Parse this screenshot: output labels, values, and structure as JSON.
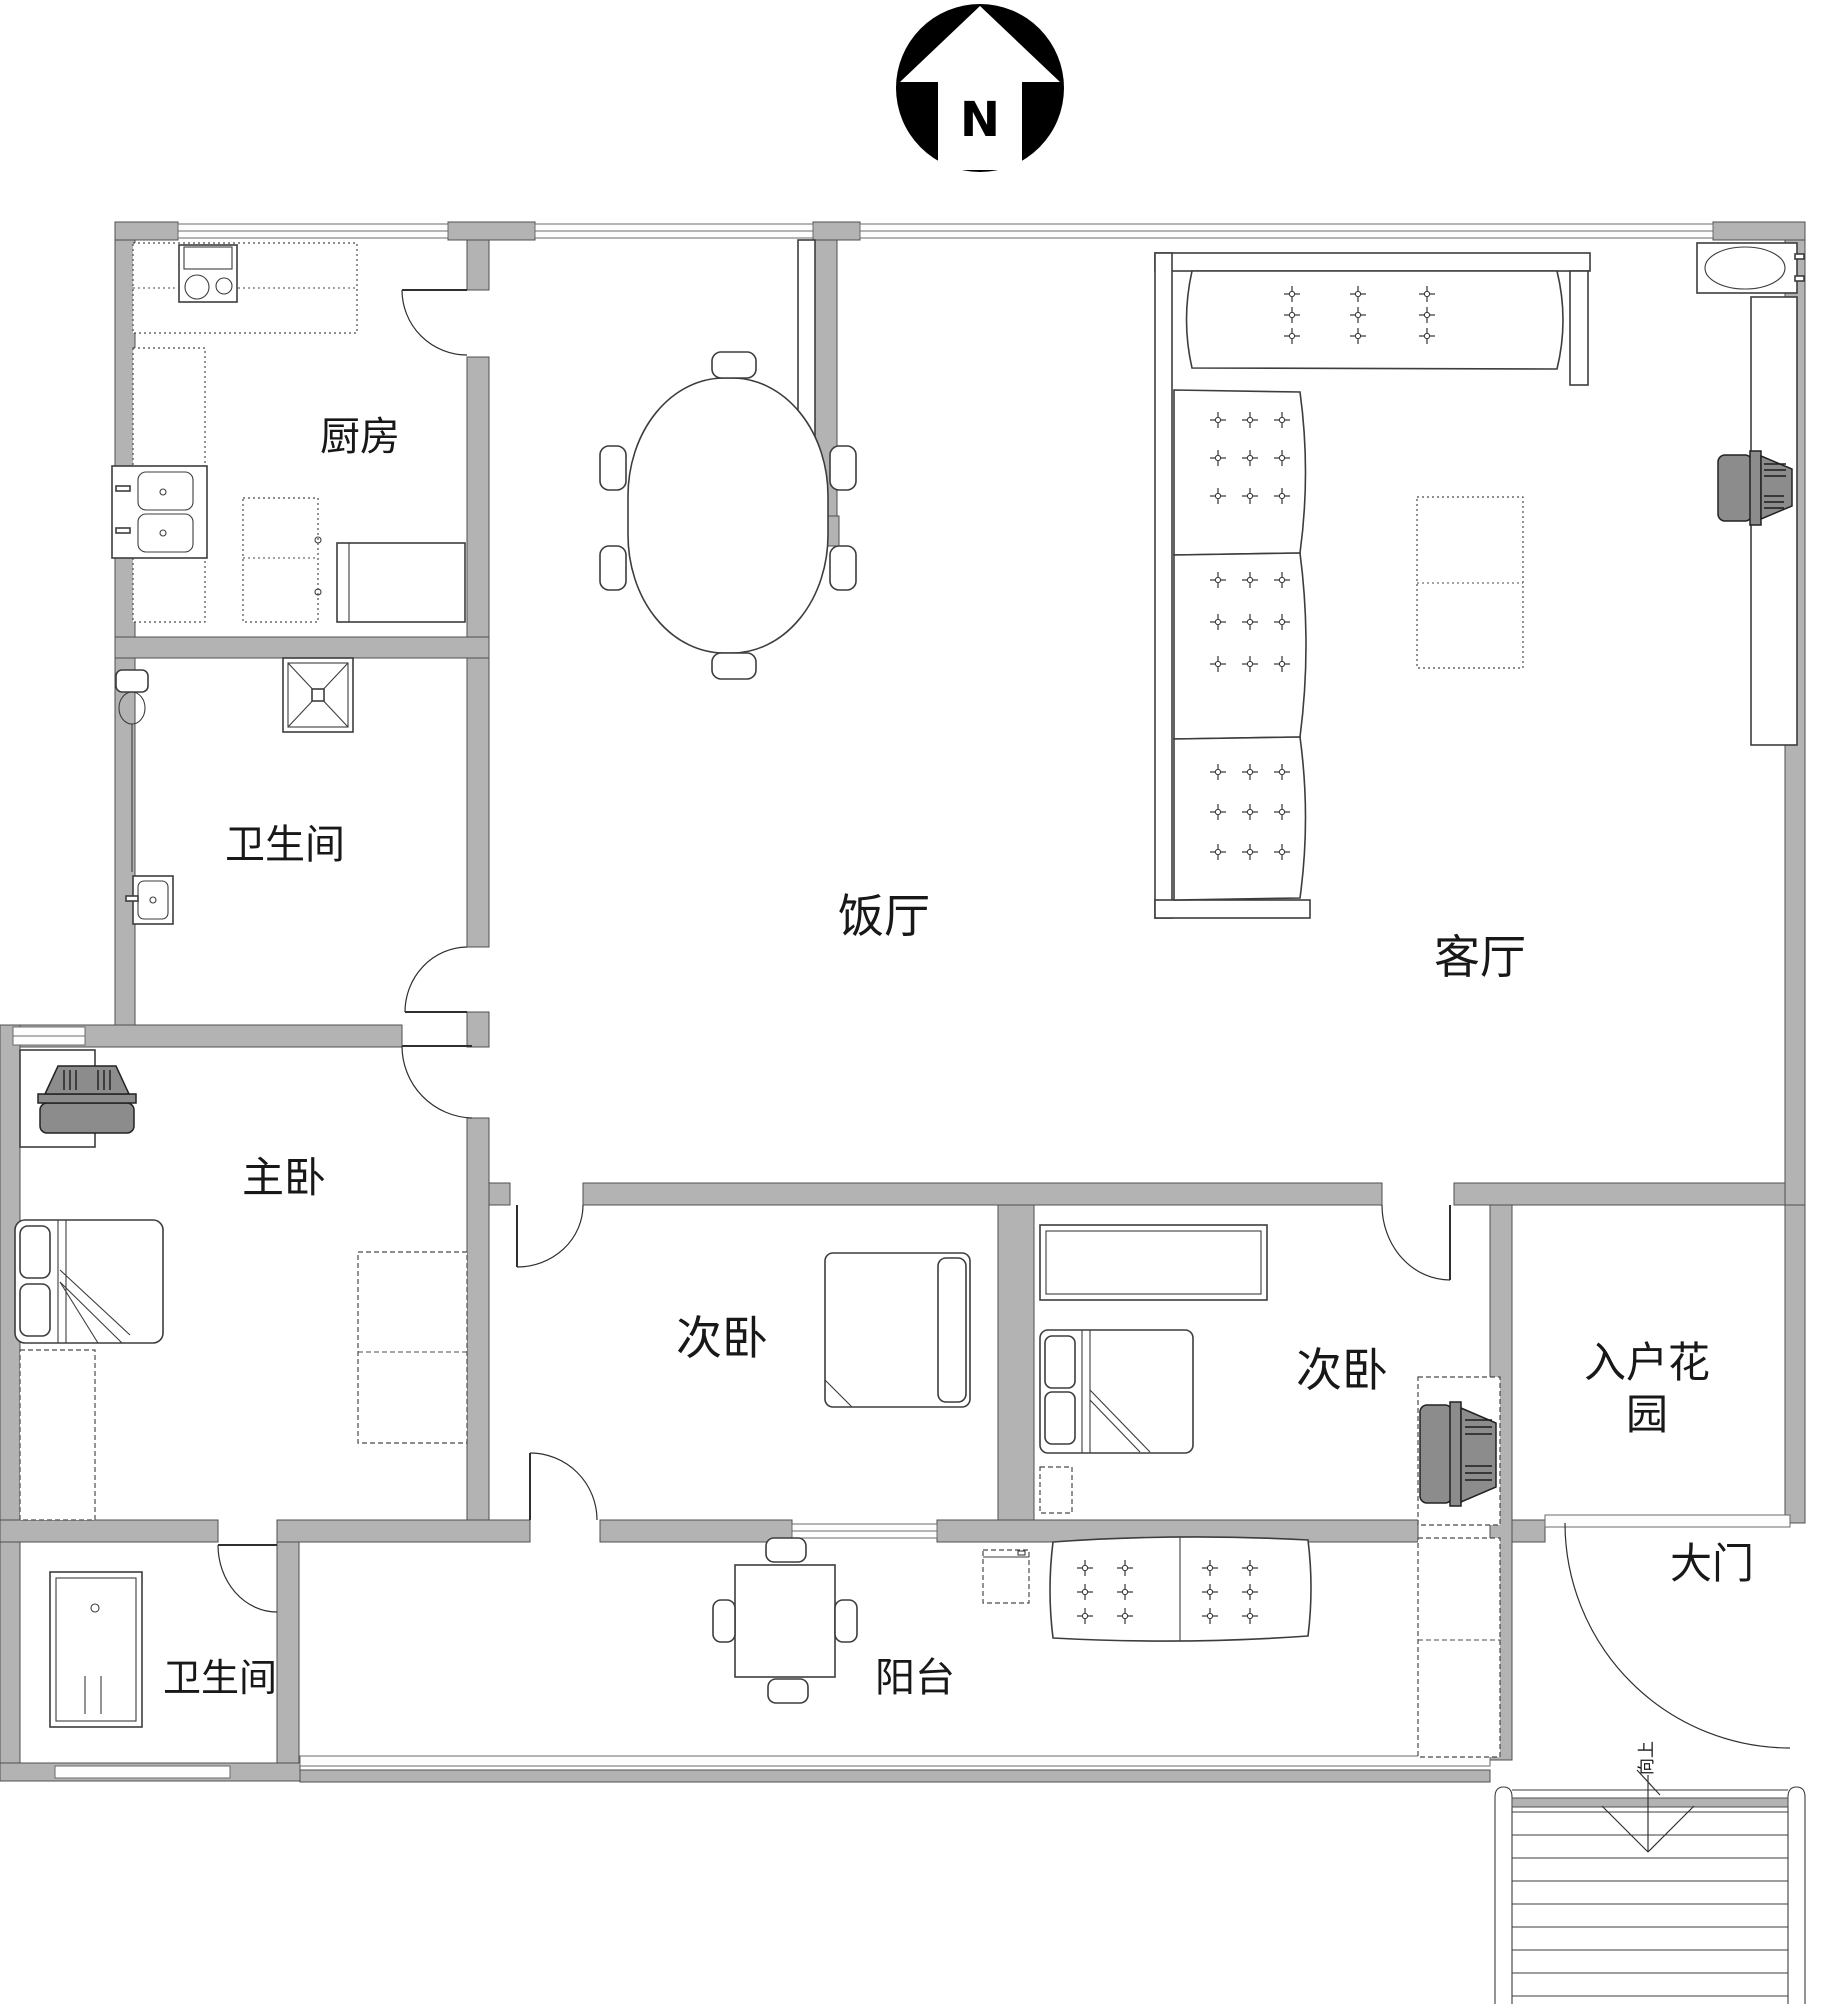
{
  "compass": {
    "label": "N"
  },
  "rooms": {
    "kitchen": "厨房",
    "bathroom_top": "卫生间",
    "dining": "饭厅",
    "living": "客厅",
    "master_bedroom": "主卧",
    "bedroom_middle": "次卧",
    "bedroom_east": "次卧",
    "entry_garden_line1": "入户花",
    "entry_garden_line2": "园",
    "main_gate": "大门",
    "bathroom_bottom": "卫生间",
    "balcony": "阳台"
  },
  "stairs": {
    "direction_label": "向上"
  },
  "colors": {
    "wall": "#b3b3b3",
    "line": "#3d3d3d",
    "appliance_dark": "#8c8c8c",
    "background": "#ffffff"
  }
}
